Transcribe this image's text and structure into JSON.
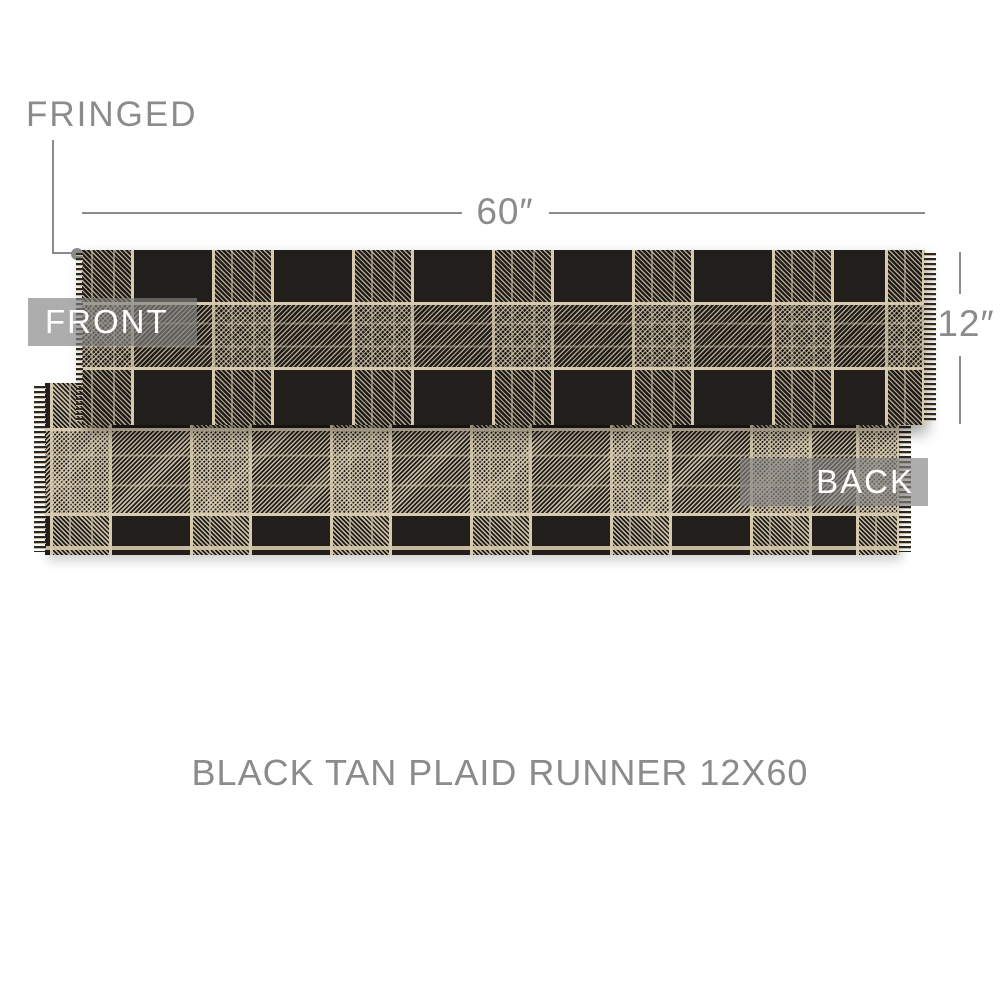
{
  "caption": "BLACK TAN PLAID RUNNER 12X60",
  "annotations": {
    "fringed_label": "FRINGED",
    "width_label": "60″",
    "height_label": "12″",
    "front_label": "FRONT",
    "back_label": "BACK"
  },
  "colors": {
    "background": "#ffffff",
    "fabric_black": "#211e1b",
    "fabric_tan": "#d7c9ad",
    "annotation_gray": "#8b8b8b",
    "badge_gray": "#838383",
    "badge_text": "#ffffff"
  }
}
